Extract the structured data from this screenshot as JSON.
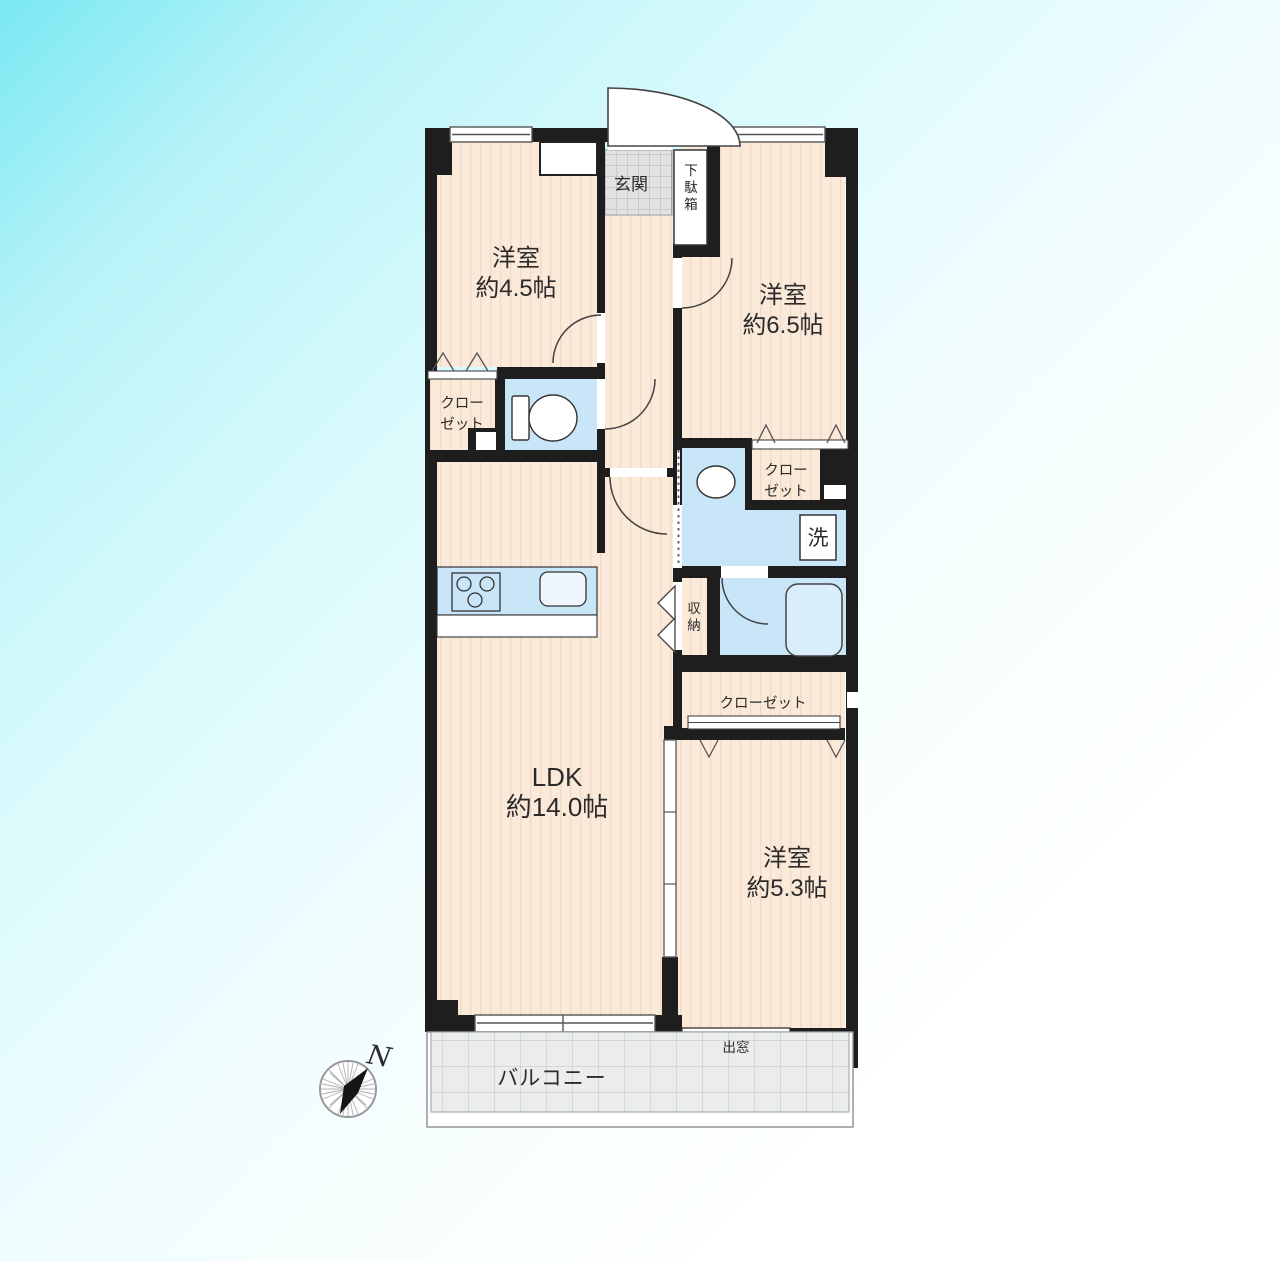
{
  "page": {
    "title": "マンション間取り図"
  },
  "colors": {
    "background_from": "#79e8f2",
    "background_to": "#ffffff",
    "wall": "#1e1e1e",
    "floor": "#fbe9d9",
    "floor_stripe": "#f0dbc6",
    "wet_area": "#c8e6f7",
    "entrance_tile": "#e2e2e2",
    "balcony_fill": "#eaecee",
    "text": "#2b2b2b"
  },
  "rooms": {
    "west_room_1": {
      "name": "洋室",
      "size": "約4.5帖"
    },
    "west_room_2": {
      "name": "洋室",
      "size": "約6.5帖"
    },
    "west_room_3": {
      "name": "洋室",
      "size": "約5.3帖"
    },
    "ldk": {
      "name": "LDK",
      "size": "約14.0帖"
    }
  },
  "labels": {
    "entrance": "玄関",
    "shoe_box": "下駄箱",
    "closet_line1": "クロー",
    "closet_line2": "ゼット",
    "closet": "クローゼット",
    "washer": "洗",
    "storage": "収納",
    "bay_window": "出窓",
    "balcony": "バルコニー",
    "compass_north": "N"
  }
}
